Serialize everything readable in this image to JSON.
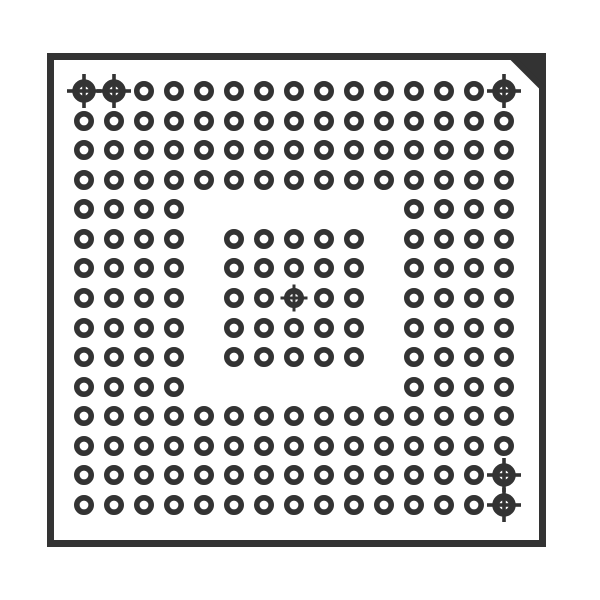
{
  "page": {
    "width": 600,
    "height": 600,
    "background": "#ffffff"
  },
  "diagram": {
    "kind": "bga-package-top-view",
    "ink_color": "#333333",
    "package_outline": {
      "outer_left": 47,
      "outer_top": 53,
      "outer_right": 546,
      "outer_bottom": 547,
      "border_width": 7,
      "chamfer_corner": "top-right",
      "chamfer_size": 34
    },
    "ball_grid": {
      "columns": 15,
      "rows": 15,
      "col_x": [
        84,
        114,
        144,
        174,
        204,
        234,
        264,
        294,
        324,
        354,
        384,
        414,
        444,
        474,
        504
      ],
      "row_y": [
        91,
        121,
        150,
        180,
        209,
        239,
        268,
        298,
        328,
        357,
        387,
        416,
        446,
        475,
        505
      ],
      "ball_outer_diameter": 20,
      "ball_ring_width": 5.6,
      "pattern": [
        "FFOOOOOOOOOOOOF",
        "OOOOOOOOOOOOOOO",
        "OOOOOOOOOOOOOOO",
        "OOOOOOOOOOOOOOO",
        "OOOO.......OOOO",
        "OOOO.OOOOO.OOOO",
        "OOOO.OOOOO.OOOO",
        "OOOO.OOCOO.OOOO",
        "OOOO.OOOOO.OOOO",
        "OOOO.OOOOO.OOOO",
        "OOOO.......OOOO",
        "OOOOOOOOOOOOOOO",
        "OOOOOOOOOOOOOOO",
        "OOOOOOOOOOOOOOF",
        "OOOOOOOOOOOOOOF"
      ],
      "legend": {
        "O": "solder-ball-pad",
        "F": "corner-fiducial-target",
        "C": "center-fiducial-target",
        ".": "empty-position"
      }
    },
    "fiducial_styles": {
      "corner": {
        "ring_outer_diameter": 23.5,
        "ring_width": 7,
        "cross_span": 34,
        "cross_width": 3.6
      },
      "center": {
        "ring_outer_diameter": 20,
        "ring_width": 5.6,
        "cross_span": 27,
        "cross_width": 3
      }
    }
  }
}
